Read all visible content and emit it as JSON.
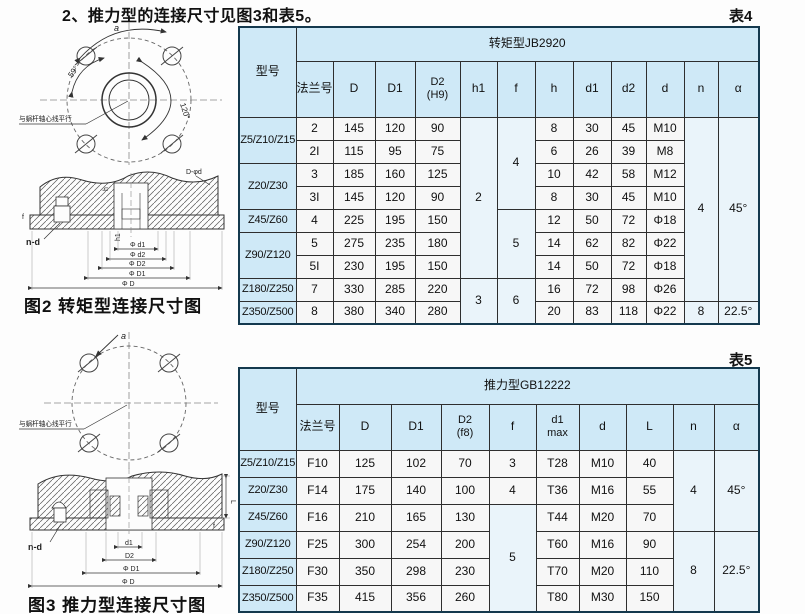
{
  "page": {
    "title": "2、推力型的连接尺寸见图3和表5。"
  },
  "figure2": {
    "caption": "图2  转矩型连接尺寸图",
    "labels": {
      "a": "a",
      "angle1": "59°",
      "angle2": "120°",
      "parallel": "与蜗杆轴心线平行",
      "n_d": "n-d",
      "hole_note": "D-φd",
      "f": "f",
      "h": "h",
      "h1": "h1",
      "dim_d1": "Φ d1",
      "dim_d2": "Φ d2",
      "dim_D2": "Φ D2",
      "dim_D1": "Φ D1",
      "dim_D": "Φ D"
    }
  },
  "figure3": {
    "caption": "图3  推力型连接尺寸图",
    "labels": {
      "a": "a",
      "parallel": "与蜗杆轴心线平行",
      "n_d": "n-d",
      "dim_d1": "d1",
      "dim_D2": "D2",
      "dim_D1": "Φ D1",
      "dim_D": "Φ D",
      "L": "L",
      "f": "f"
    }
  },
  "table4": {
    "label": "表4",
    "model_header": "型号",
    "group_header": "转矩型JB2920",
    "headers": {
      "flange": "法兰号",
      "D": "D",
      "D1": "D1",
      "D2": "D2",
      "D2_sub": "(H9)",
      "h1": "h1",
      "f": "f",
      "h": "h",
      "d1": "d1",
      "d2": "d2",
      "d": "d",
      "n": "n",
      "alpha": "α"
    },
    "spans": {
      "h1_top": "2",
      "h1_bottom": "3",
      "f_top": "4",
      "f_mid": "5",
      "f_bottom": "6",
      "n_top": "4",
      "alpha_top": "45°",
      "n_bottom": "8",
      "alpha_bottom": "22.5°"
    },
    "rows": [
      {
        "model": "Z5/Z10/Z15",
        "flange": "2",
        "D": "145",
        "D1": "120",
        "D2": "90",
        "h": "8",
        "d1": "30",
        "d2": "45",
        "d": "M10"
      },
      {
        "flange": "2I",
        "D": "115",
        "D1": "95",
        "D2": "75",
        "h": "6",
        "d1": "26",
        "d2": "39",
        "d": "M8"
      },
      {
        "model": "Z20/Z30",
        "flange": "3",
        "D": "185",
        "D1": "160",
        "D2": "125",
        "h": "10",
        "d1": "42",
        "d2": "58",
        "d": "M12"
      },
      {
        "flange": "3I",
        "D": "145",
        "D1": "120",
        "D2": "90",
        "h": "8",
        "d1": "30",
        "d2": "45",
        "d": "M10"
      },
      {
        "model": "Z45/Z60",
        "flange": "4",
        "D": "225",
        "D1": "195",
        "D2": "150",
        "h": "12",
        "d1": "50",
        "d2": "72",
        "d": "Φ18"
      },
      {
        "model": "Z90/Z120",
        "flange": "5",
        "D": "275",
        "D1": "235",
        "D2": "180",
        "h": "14",
        "d1": "62",
        "d2": "82",
        "d": "Φ22"
      },
      {
        "flange": "5I",
        "D": "230",
        "D1": "195",
        "D2": "150",
        "h": "14",
        "d1": "50",
        "d2": "72",
        "d": "Φ18"
      },
      {
        "model": "Z180/Z250",
        "flange": "7",
        "D": "330",
        "D1": "285",
        "D2": "220",
        "h": "16",
        "d1": "72",
        "d2": "98",
        "d": "Φ26"
      },
      {
        "model": "Z350/Z500",
        "flange": "8",
        "D": "380",
        "D1": "340",
        "D2": "280",
        "h": "20",
        "d1": "83",
        "d2": "118",
        "d": "Φ22"
      }
    ]
  },
  "table5": {
    "label": "表5",
    "model_header": "型号",
    "group_header": "推力型GB12222",
    "headers": {
      "flange": "法兰号",
      "D": "D",
      "D1": "D1",
      "D2": "D2",
      "D2_sub": "(f8)",
      "f": "f",
      "d1": "d1",
      "d1_sub": "max",
      "d": "d",
      "L": "L",
      "n": "n",
      "alpha": "α"
    },
    "spans": {
      "f_span": "5",
      "n_top": "4",
      "alpha_top": "45°",
      "n_bottom": "8",
      "alpha_bottom": "22.5°"
    },
    "rows": [
      {
        "model": "Z5/Z10/Z15",
        "flange": "F10",
        "D": "125",
        "D1": "102",
        "D2": "70",
        "f": "3",
        "d1": "T28",
        "d": "M10",
        "L": "40"
      },
      {
        "model": "Z20/Z30",
        "flange": "F14",
        "D": "175",
        "D1": "140",
        "D2": "100",
        "f": "4",
        "d1": "T36",
        "d": "M16",
        "L": "55"
      },
      {
        "model": "Z45/Z60",
        "flange": "F16",
        "D": "210",
        "D1": "165",
        "D2": "130",
        "d1": "T44",
        "d": "M20",
        "L": "70"
      },
      {
        "model": "Z90/Z120",
        "flange": "F25",
        "D": "300",
        "D1": "254",
        "D2": "200",
        "d1": "T60",
        "d": "M16",
        "L": "90"
      },
      {
        "model": "Z180/Z250",
        "flange": "F30",
        "D": "350",
        "D1": "298",
        "D2": "230",
        "d1": "T70",
        "d": "M20",
        "L": "110"
      },
      {
        "model": "Z350/Z500",
        "flange": "F35",
        "D": "415",
        "D1": "356",
        "D2": "260",
        "d1": "T80",
        "d": "M30",
        "L": "150"
      }
    ]
  }
}
